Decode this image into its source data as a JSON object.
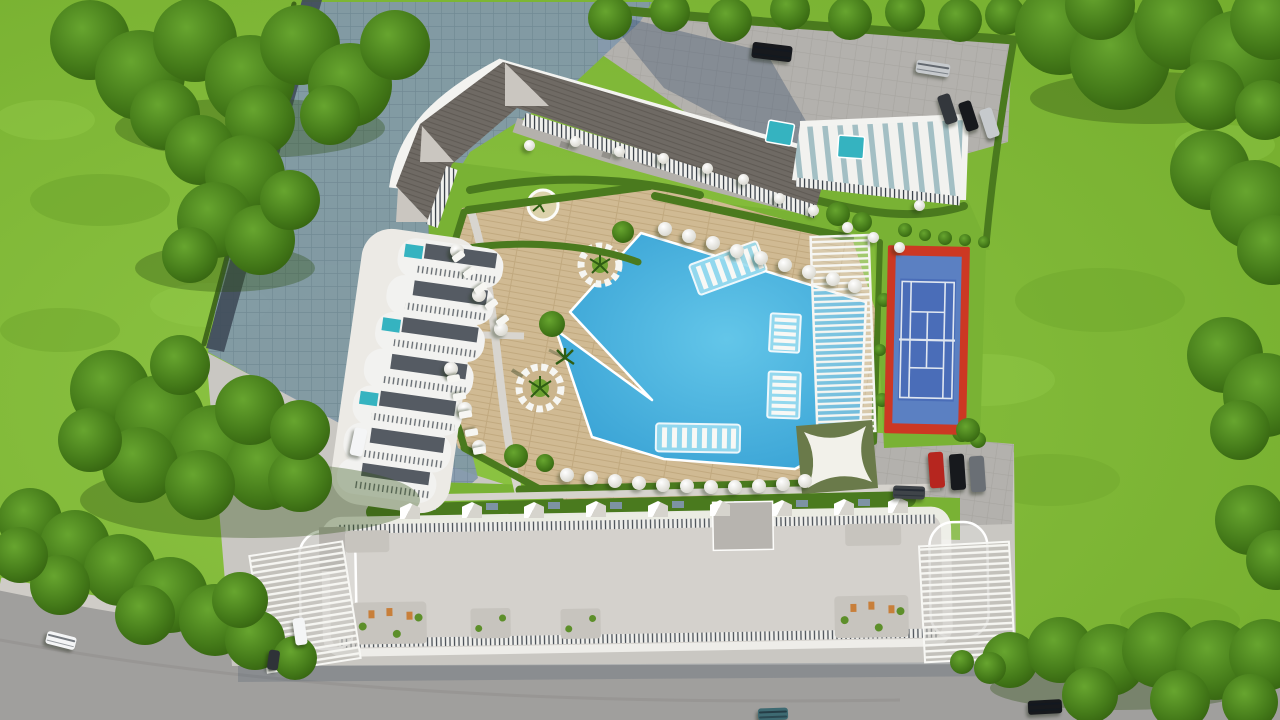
{
  "meta": {
    "domain": "Natural-Image",
    "description": "Aerial top-down 3D architectural rendering of a residential resort complex with curved apartment blocks, a free-form swimming pool, tennis court, shade structures, gardens, parking areas and a perimeter road.",
    "visible_text": "none"
  },
  "scene": {
    "palette": {
      "grass": "#80b936",
      "grassLight": "#97cf4e",
      "grassDark": "#679e28",
      "tree": "#447a19",
      "treeDark": "#2f5a11",
      "hedge": "#4a7a1e",
      "lawn": "#79b234",
      "deck": "#d0ba93",
      "pool": "#3fa9d8",
      "poolLight": "#9adcf0",
      "roof": "#6f6a64",
      "white": "#f2f2ef",
      "pave": "#c9c7c2",
      "parking": "#b3b1ad",
      "road": "#a09f9d",
      "sidewalk": "#cfccc7",
      "shadow": "rgba(42,66,98,0.48)",
      "shadowPave": "#8298ac",
      "tennisRed": "#cc3823",
      "tennisBlue": "#5b80c2",
      "tennisBlueDark": "#4a6db8",
      "teal": "#35b3c0",
      "sail": "#f2f1ea",
      "sailPad": "#6a7a4a",
      "carRed": "#b6261f",
      "carBlack": "#17191d",
      "carSilver": "#c6cacd",
      "carWhite": "#f4f5f6",
      "carTeal": "#3e6a72",
      "patio": "#c7c4be"
    },
    "elements": {
      "main_building": "angular block with dark hatched roof, white rim walkway, striped balcony edges and three white gables",
      "tower": "seven cascading white terraces with plunge pools stepping down-left",
      "ne_wing": "white ribbed wing with teal glass strips and rooftop pools",
      "pool": "free-form lagoon pool with zigzag deck edge, two circular lounger islands with palms, four in-pool lounger shelves",
      "tennis_court": "blue court with white lines on red surround",
      "pergola": "white slatted pergola strip between pool deck and tennis court",
      "shade_sail": "white four-point sail on dark olive pad",
      "garden_cabins": "row of white pyramid-roof cabins between pool and south building",
      "south_building": "long flat-roof block with white railings, roof patios and slatted carports at both ends",
      "roads": "curved perimeter road bottom-left to bottom-right with sidewalk"
    },
    "counts": {
      "umbrellas": 38,
      "sun_loungers": 10,
      "garden_cabins": 9,
      "cars": 14,
      "tennis_courts": 1,
      "circular_lounger_islands": 2,
      "in_pool_lounger_shelves": 4,
      "rooftop_pools": 2
    }
  }
}
